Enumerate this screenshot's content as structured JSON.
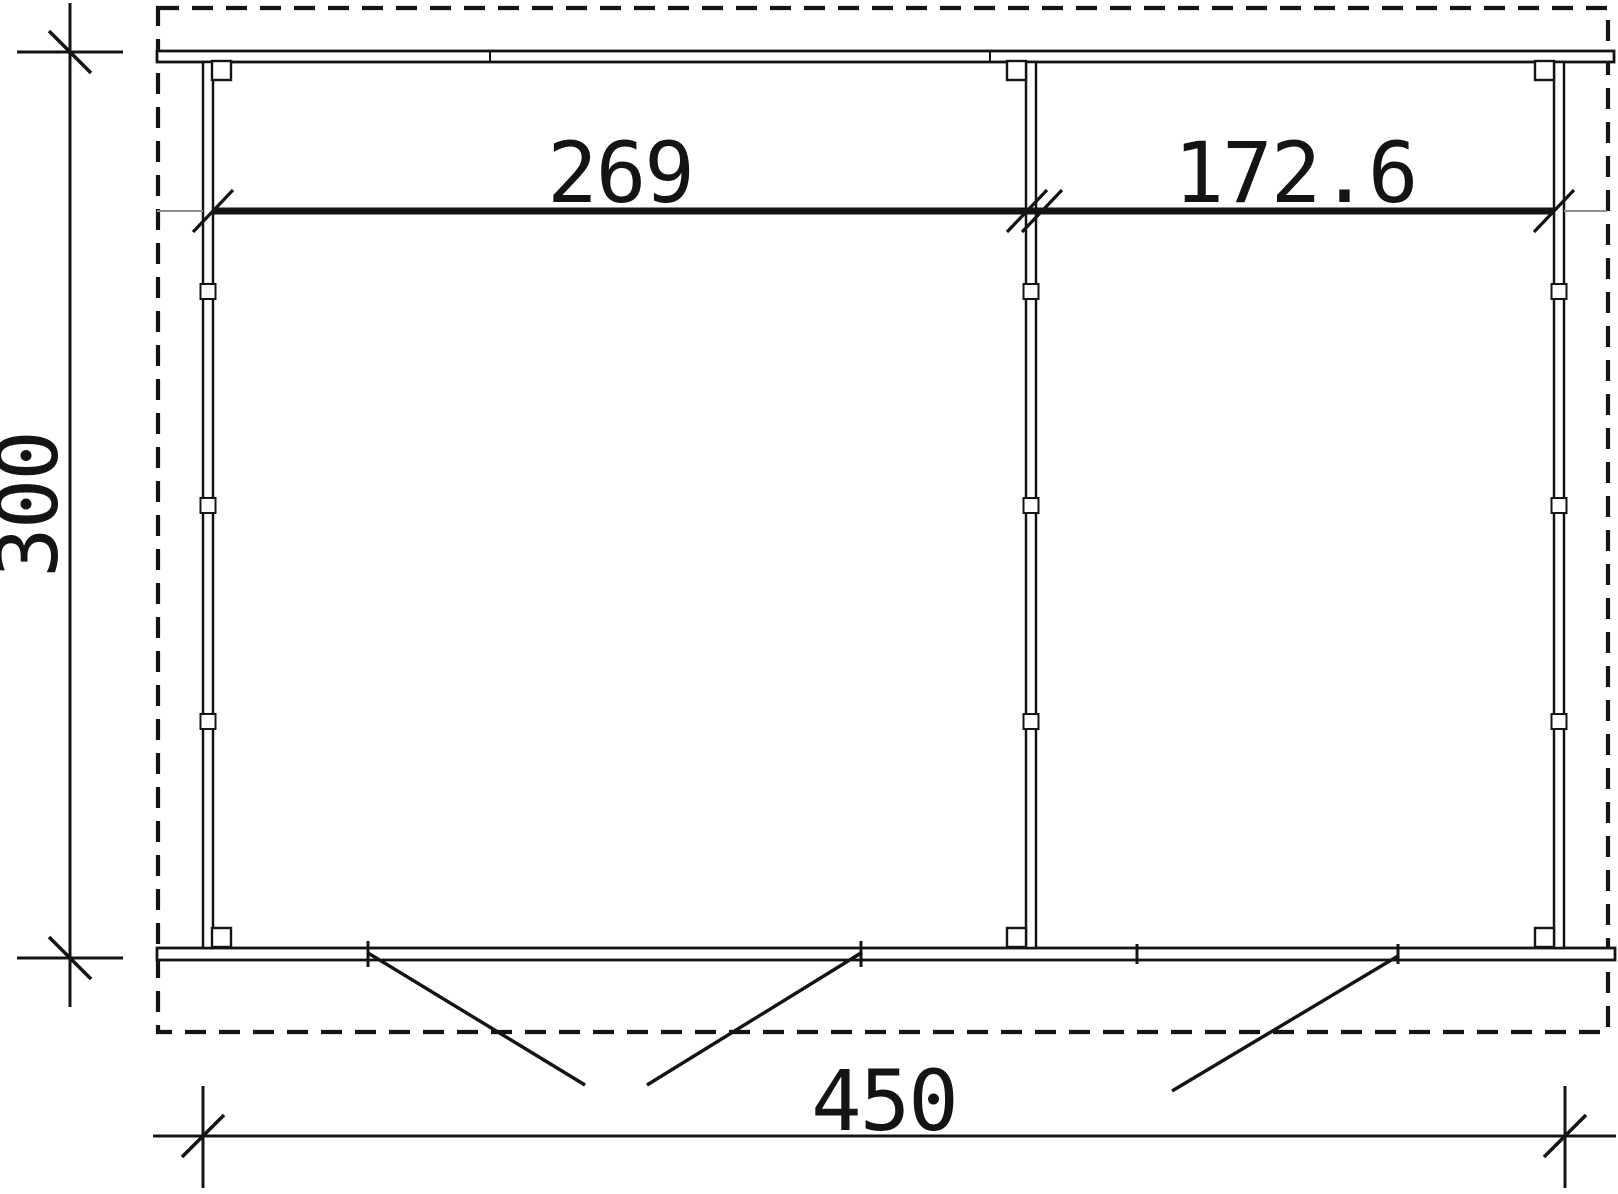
{
  "drawing_title": "floor-plan",
  "colors": {
    "line": "#141414",
    "extension": "#8e8e8e",
    "background": "#ffffff"
  },
  "dimensions": {
    "room_left_width": "269",
    "room_right_width": "172.6",
    "outer_depth": "300",
    "outer_width": "450"
  }
}
